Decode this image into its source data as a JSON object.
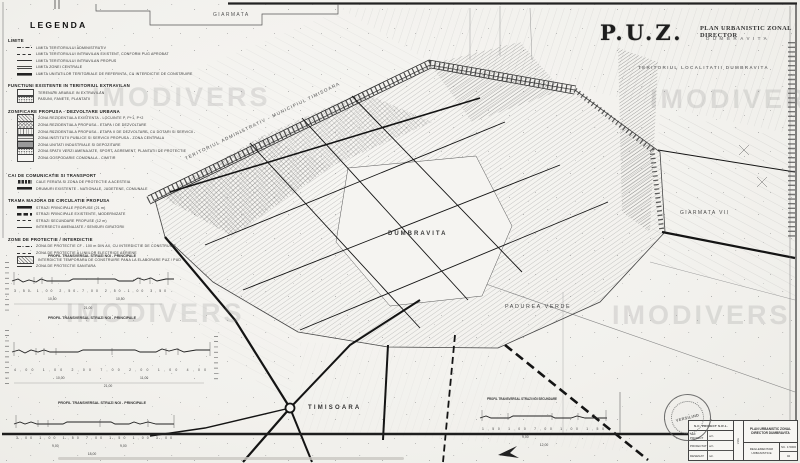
{
  "watermark": {
    "text": "IMODIVERS"
  },
  "header": {
    "puz": "P.U.Z.",
    "subtitle": "PLAN URBANISTIC ZONAL DIRECTOR",
    "locality": "DUMBRAVITA",
    "caption": "TERITORIUL LOCALITATII DUMBRAVITA"
  },
  "legend": {
    "title": "LEGENDA",
    "sections": [
      {
        "heading": "LIMITE",
        "items": [
          {
            "symbol": "sym-line-dashdot",
            "label": "LIMITA TERITORIULUI ADMINISTRATIV"
          },
          {
            "symbol": "sym-line-dash",
            "label": "LIMITA TERITORIULUI INTRAVILAN EXISTENT, CONFORM PUG APROBAT"
          },
          {
            "symbol": "sym-line-solid",
            "label": "LIMITA TERITORIULUI INTRAVILAN PROPUS"
          },
          {
            "symbol": "sym-line-double",
            "label": "LIMITA ZONEI CENTRALE"
          },
          {
            "symbol": "sym-line-thick",
            "label": "LIMITA UNITATILOR TERITORIALE DE REFERINTA, CU INTERDICTIE DE CONSTRUIRE"
          }
        ]
      },
      {
        "heading": "FUNCTIUNI EXISTENTE IN TERITORIUL EXTRAVILAN",
        "items": [
          {
            "symbol": "sym-swatch-blank",
            "label": "TERENURI ARABILE IN EXTRAVILAN"
          },
          {
            "symbol": "sym-swatch-dots",
            "label": "PASUNI, FANETE, PLANTATII"
          }
        ]
      },
      {
        "heading": "ZONIFICARE PROPUSA - DEZVOLTARE URBANA",
        "items": [
          {
            "symbol": "sym-swatch-hatch",
            "label": "ZONA REZIDENTIALA EXISTENTA - LOCUINTE P, P+1, P+2"
          },
          {
            "symbol": "sym-swatch-cross",
            "label": "ZONA REZIDENTIALA PROPUSA - ETAPA I DE DEZVOLTARE"
          },
          {
            "symbol": "sym-swatch-vert",
            "label": "ZONA REZIDENTIALA PROPUSA - ETAPA II DE DEZVOLTARE, CU DOTARI SI SERVICII"
          },
          {
            "symbol": "sym-swatch-horiz",
            "label": "ZONA INSTITUTII PUBLICE SI SERVICII PROPUSA - ZONA CENTRALA"
          },
          {
            "symbol": "sym-swatch-dark",
            "label": "ZONA UNITATI INDUSTRIALE SI DEPOZITARE"
          },
          {
            "symbol": "sym-swatch-dots",
            "label": "ZONA SPATII VERZI AMENAJATE, SPORT, AGREMENT, PLANTATII DE PROTECTIE"
          },
          {
            "symbol": "sym-swatch-blank",
            "label": "ZONA GOSPODARIE COMUNALA - CIMITIR"
          }
        ]
      },
      {
        "heading": "CAI DE COMUNICATIE SI TRANSPORT",
        "items": [
          {
            "symbol": "sym-rail",
            "label": "CALE FERATA SI ZONA DE PROTECTIE A ACESTEIA"
          },
          {
            "symbol": "sym-line-thick",
            "label": "DRUMURI EXISTENTE - NATIONALE, JUDETENE, COMUNALE"
          }
        ]
      },
      {
        "heading": "TRAMA MAJORA  DE CIRCULATIE PROPUSA",
        "items": [
          {
            "symbol": "sym-line-thick",
            "label": "STRAZI PRINCIPALE PROPUSE (21 m)"
          },
          {
            "symbol": "sym-road-dash",
            "label": "STRAZI PRINCIPALE EXISTENTE, MODERNIZATE"
          },
          {
            "symbol": "sym-line-dash",
            "label": "STRAZI SECUNDARE PROPUSE (12 m)"
          },
          {
            "symbol": "sym-line-solid",
            "label": "INTERSECTII AMENAJATE / SENSURI GIRATORII"
          }
        ]
      },
      {
        "heading": "ZONE DE PROTECTIE / INTERDICTIE",
        "items": [
          {
            "symbol": "sym-line-dashdot",
            "label": "ZONA DE PROTECTIE CF - 100 m DIN AX, CU INTERDICTIE DE CONSTRUIRE"
          },
          {
            "symbol": "sym-line-dash",
            "label": "ZONA DE PROTECTIE A LINIILOR ELECTRICE AERIENE"
          },
          {
            "symbol": "sym-swatch-hatch",
            "label": "INTERDICTIE TEMPORARA DE CONSTRUIRE PANA LA ELABORARE PUZ / PUD"
          },
          {
            "symbol": "sym-line-solid",
            "label": "ZONA DE PROTECTIE SANITARA"
          }
        ]
      }
    ]
  },
  "map_labels": {
    "giarmata": "GIARMATA",
    "admin_boundary": "TERITORIUL ADMINISTRATIV - MUNICIPIUL TIMISOARA",
    "dumbravita": "DUMBRAVITA",
    "padurea_verde": "PADUREA VERDE",
    "giarmata_vii": "GIARMATA VII",
    "timisoara": "TIMISOARA"
  },
  "profiles": {
    "p1": {
      "title": "PROFIL TRANSVERSAL STRAZI NOI - PRINCIPALE",
      "dims": "3,50 1,00 2,50 7,00 2,50 1,00 3,50",
      "sub_left": "10,50",
      "sub_right": "10,50",
      "total": "21,00"
    },
    "p2": {
      "title": "PROFIL TRANSVERSAL STRAZI NOI - PRINCIPALE",
      "dims": "4,00 1,00 2,00 7,00 2,00 1,00 4,00",
      "sub_left": "10,00",
      "sub_right": "11,00",
      "total": "21,00"
    },
    "p3": {
      "title": "PROFIL TRANSVERSAL STRAZI NOI - PRINCIPALE",
      "dims": "3,00 1,00 1,50 7,00 1,50 1,00 3,00",
      "sub_left": "9,00",
      "sub_right": "9,00",
      "total": "18,00"
    },
    "p4": {
      "title": "PROFIL TRANSVERSAL STRAZI NOI SECUNDARE",
      "dims": "1,50 1,00 7,00 1,00 1,50",
      "sub_left": "9,00",
      "total": "12,00"
    }
  },
  "stamp": {
    "text": "VERSILIND"
  },
  "cartouche": {
    "company": "S.C. PROIECT S.R.L.",
    "rows": [
      [
        "SEF PROIECT",
        "arh."
      ],
      [
        "PROIECTAT",
        "arh."
      ],
      [
        "DESENAT",
        "teh."
      ]
    ],
    "mid_label": "VIZE",
    "project": "PLAN URBANISTIC ZONAL DIRECTOR DUMBRAVITA",
    "plansa": "REGLEMENTARI URBANISTICE",
    "scale": "SC. 1:5000",
    "plate": "02"
  }
}
